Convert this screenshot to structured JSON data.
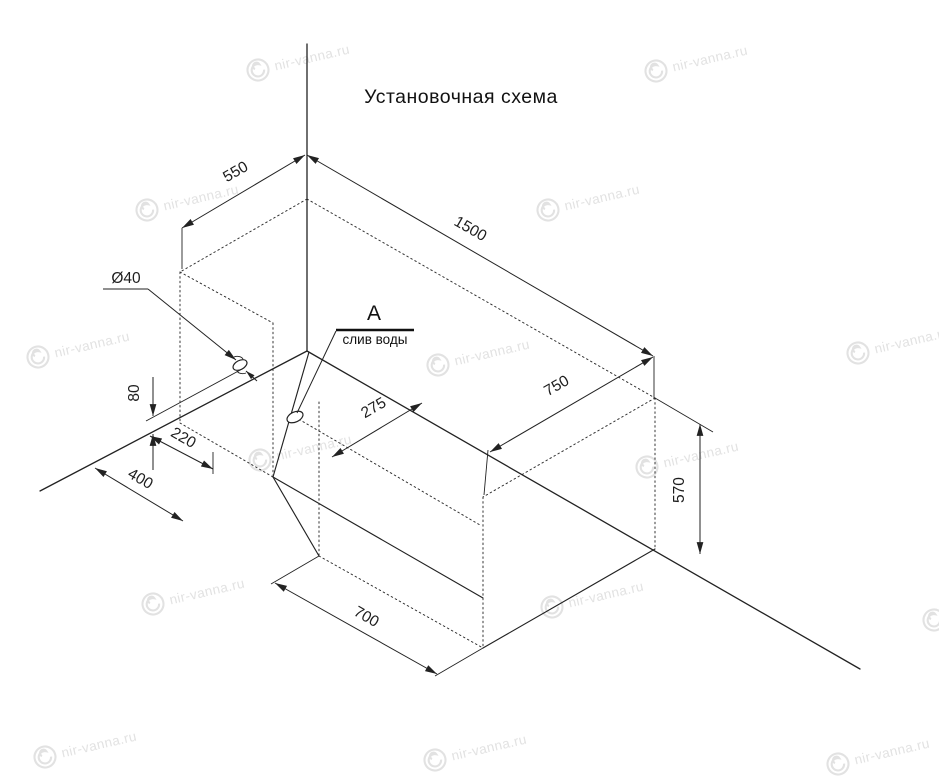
{
  "title": "Установочная схема",
  "watermark": {
    "text": "nir-vanna.ru"
  },
  "callout": {
    "letter": "А",
    "caption": "слив воды"
  },
  "dims": {
    "head_width": "550",
    "length": "1500",
    "foot_width": "750",
    "height": "570",
    "bottom_length": "700",
    "floor_offset_outer": "400",
    "floor_offset_inner": "220",
    "drain_offset": "275",
    "wall_hole_height": "80",
    "wall_hole_diameter": "Ø40"
  },
  "colors": {
    "line": "#222222",
    "text": "#1d1d1d",
    "watermark": "#e2e2e2",
    "background": "#ffffff"
  }
}
